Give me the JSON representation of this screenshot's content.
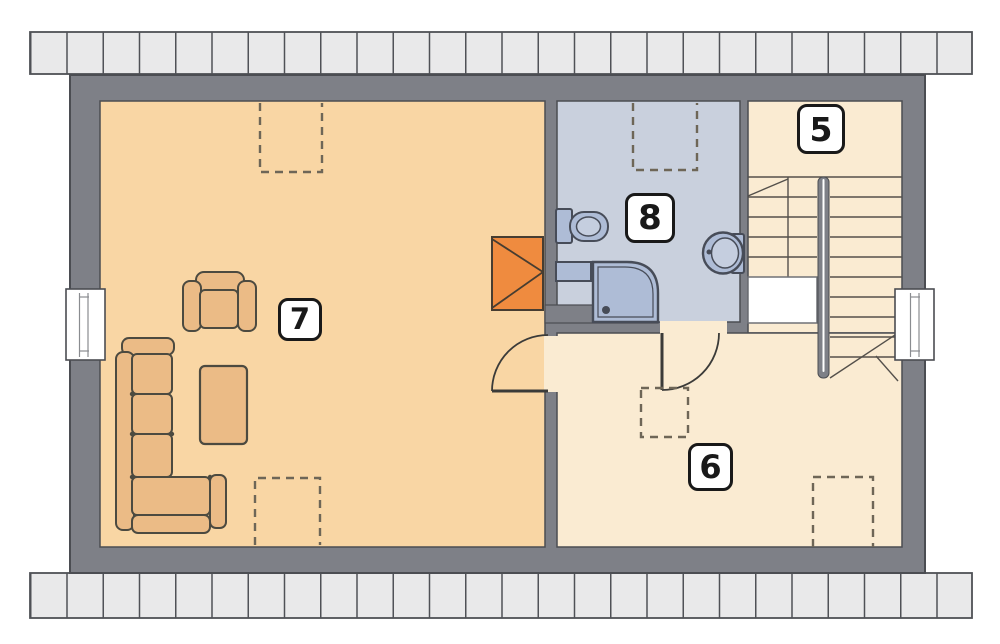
{
  "plan": {
    "type": "floor-plan",
    "rooms": {
      "living": {
        "label": "7"
      },
      "bath": {
        "label": "8"
      },
      "stair": {
        "label": "5"
      },
      "hall": {
        "label": "6"
      }
    }
  },
  "colors": {
    "wall": "#7E8087",
    "outline": "#4B4D52",
    "living": "#F9D6A4",
    "hall": "#FAEBD2",
    "bath": "#C9D0DD",
    "strip": "#E9E9EA",
    "stripline": "#4F5156",
    "furn": "#EBBB86",
    "furnline": "#4C4A40",
    "chimney": "#EF8B3F",
    "chimline": "#473D31",
    "fix": "#AEBCD6",
    "fixlight": "#C5CEDF",
    "fixline": "#474C58",
    "door": "#3B3B39",
    "stair": "#54504B",
    "dash": "#6E6657",
    "label": "#191919",
    "white": "#FFFFFF"
  }
}
